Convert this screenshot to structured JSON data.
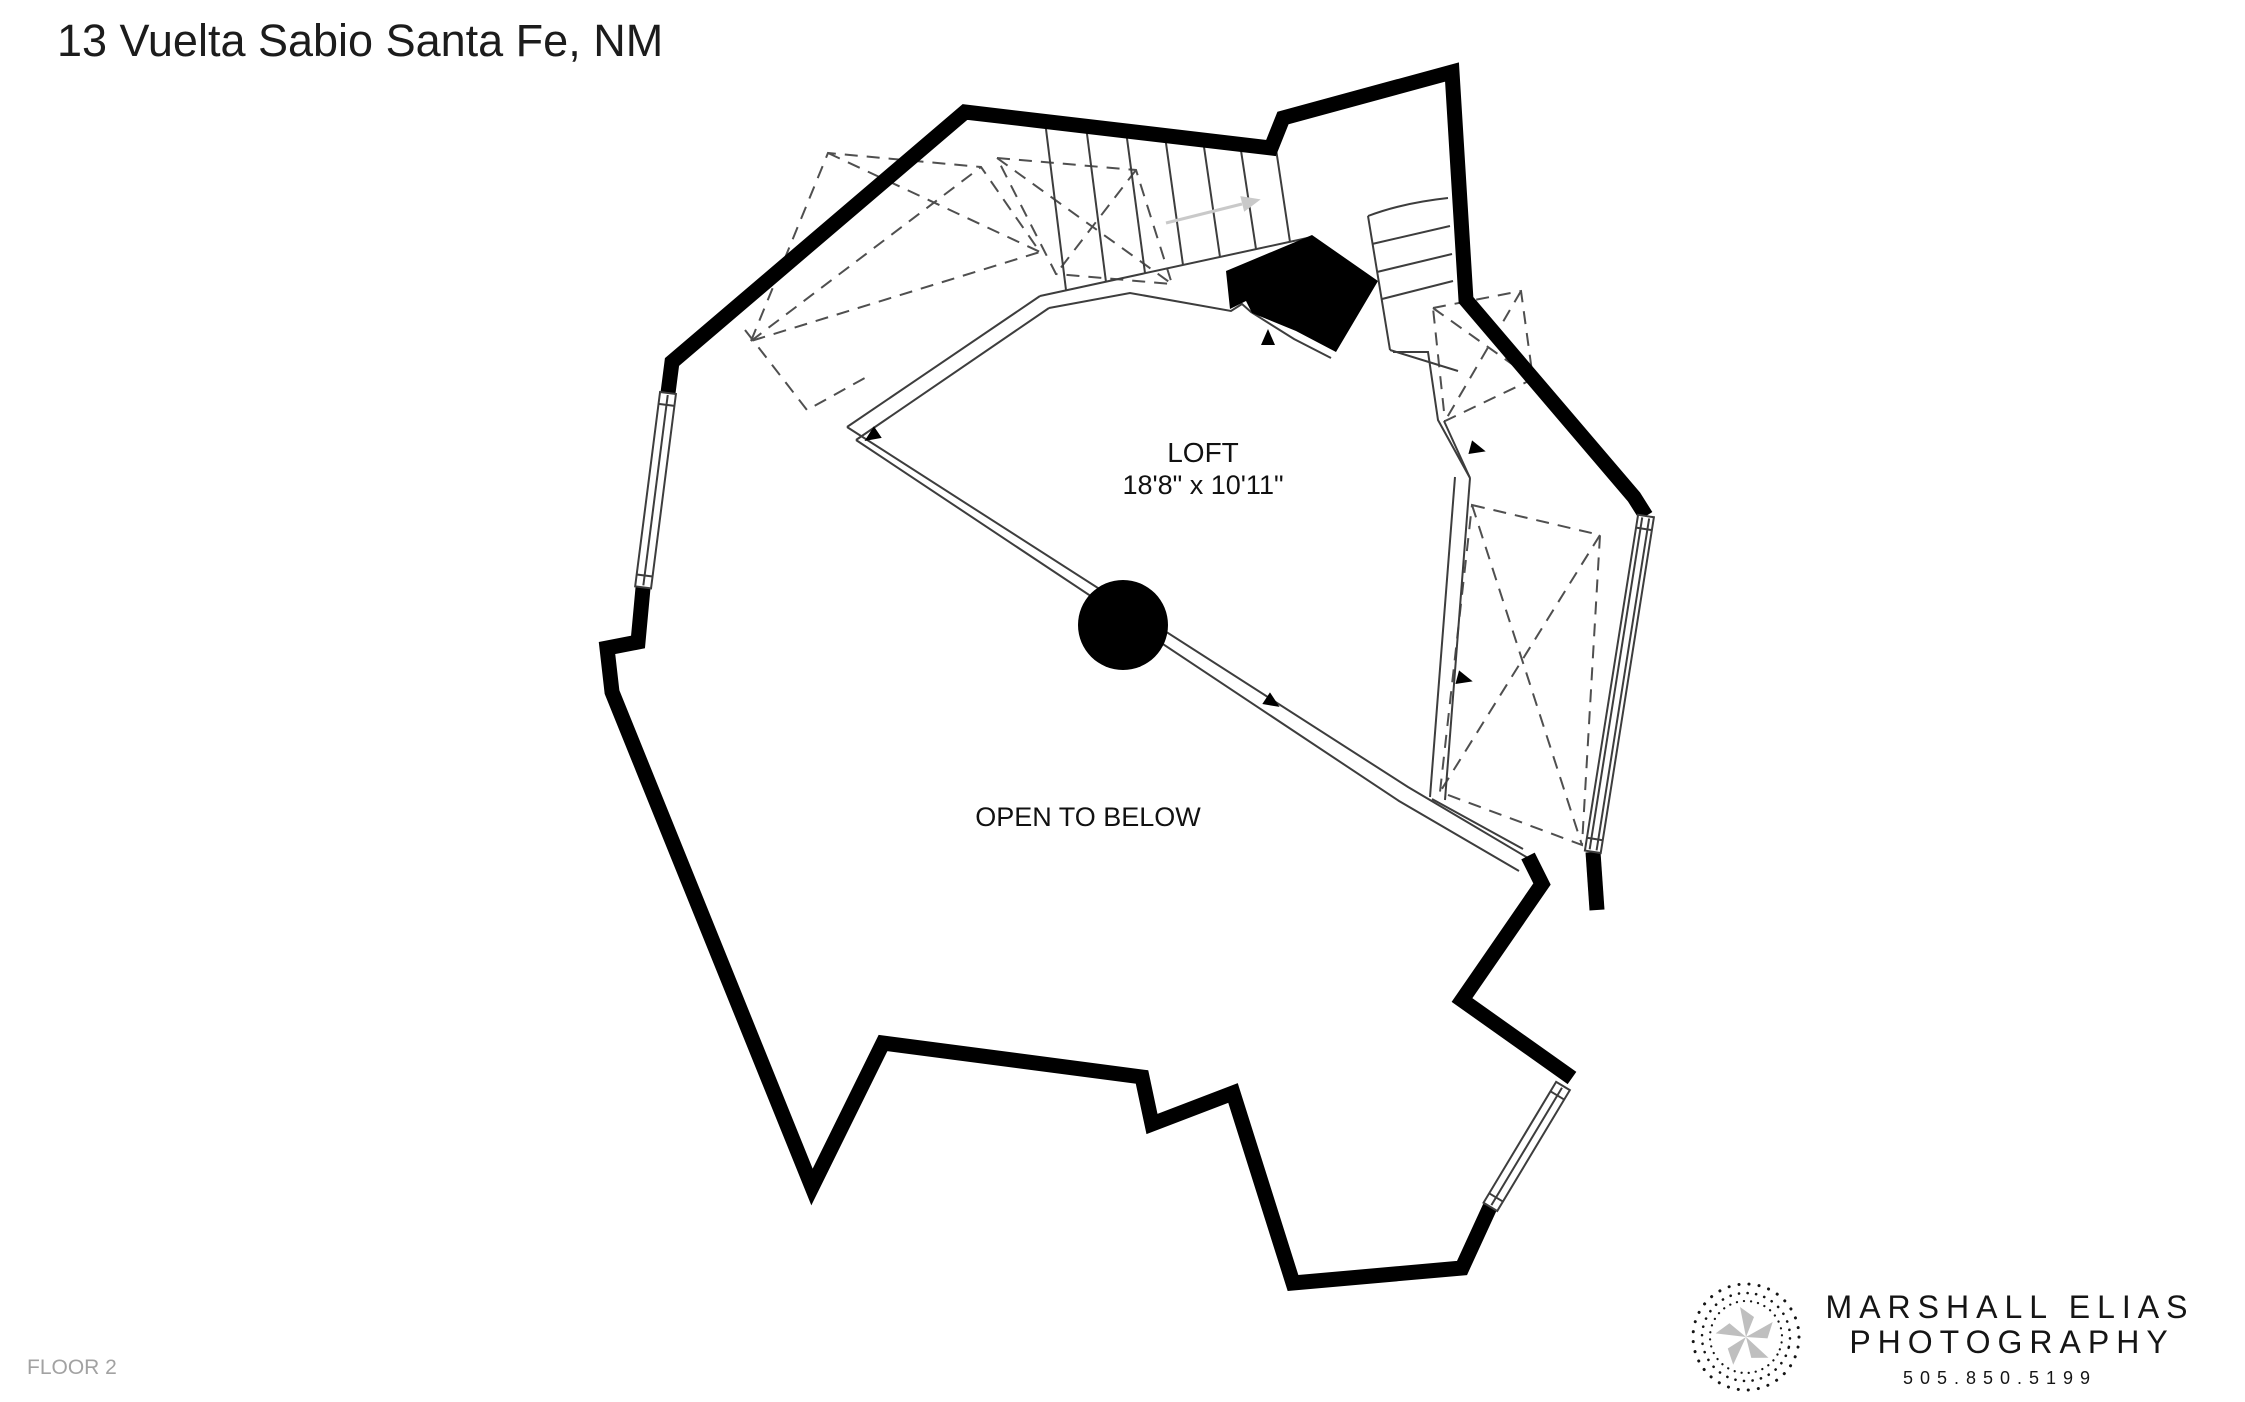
{
  "title": "13 Vuelta Sabio Santa Fe, NM",
  "floor_label": "FLOOR 2",
  "rooms": {
    "loft": {
      "name": "LOFT",
      "dimensions": "18'8\" x 10'11\""
    },
    "open_to_below": {
      "label": "OPEN TO BELOW"
    }
  },
  "branding": {
    "line1": "MARSHALL ELIAS",
    "line2": "PHOTOGRAPHY",
    "phone": "505.850.5199"
  },
  "colors": {
    "background": "#ffffff",
    "wall": "#000000",
    "line": "#3d3d3d",
    "dashed": "#4f4f4f",
    "stair_arrow": "#c9c9c9",
    "title_text": "#1c1c1c",
    "floor_label_text": "#a2a2a2",
    "logo_ink": "#151515",
    "logo_star": "#bfbfbf"
  }
}
